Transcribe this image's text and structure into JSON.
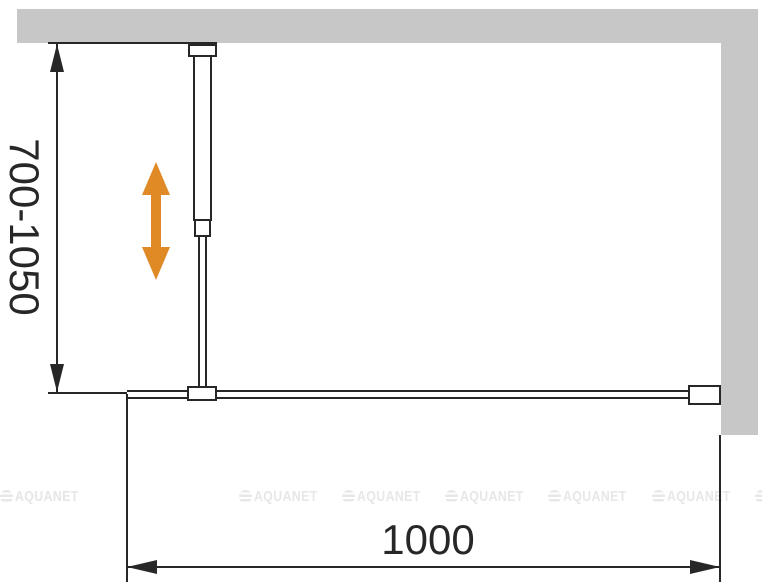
{
  "diagram": {
    "vertical_dimension": {
      "label": "700-1050"
    },
    "horizontal_dimension": {
      "label": "1000"
    },
    "colors": {
      "wall_gray": "#c7c7c7",
      "line_black": "#272727",
      "arrow_orange": "#e08a26",
      "watermark_gray": "#e7e7e7"
    }
  },
  "watermark": {
    "text": "AQUANET",
    "instances": 8
  }
}
